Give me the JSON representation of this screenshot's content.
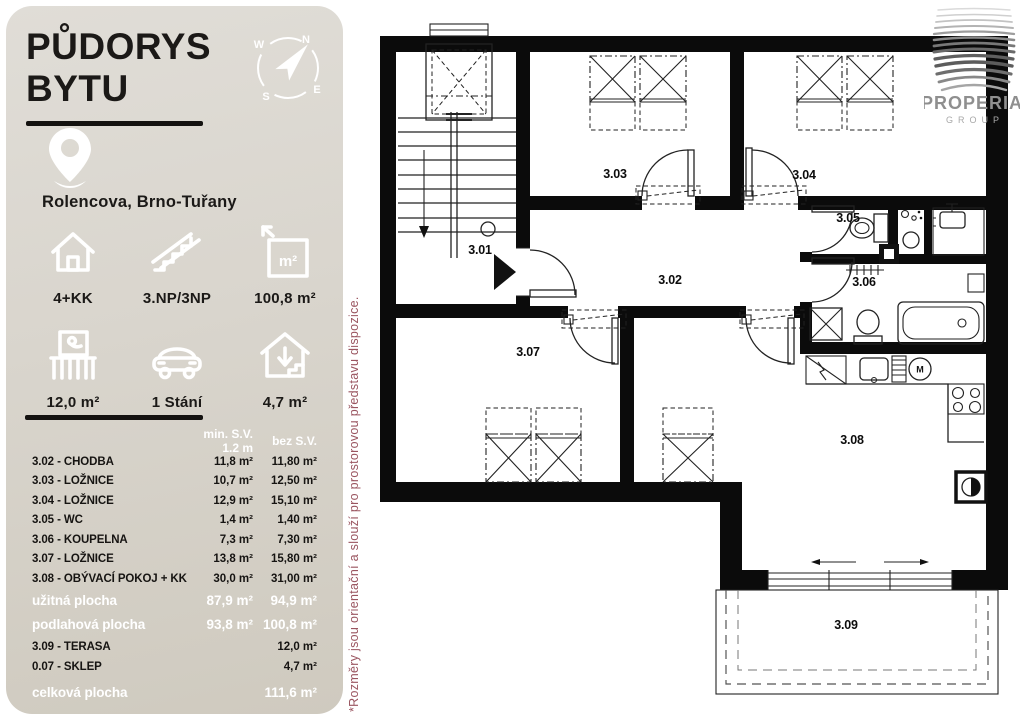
{
  "sidebar": {
    "title_line1": "PŮDORYS",
    "title_line2": "BYTU",
    "location": "Rolencova, Brno-Tuřany",
    "stats": [
      {
        "icon": "house-icon",
        "label": "4+KK"
      },
      {
        "icon": "stairs-icon",
        "label": "3.NP/3NP"
      },
      {
        "icon": "area-icon",
        "label": "100,8 m²"
      },
      {
        "icon": "balcony-icon",
        "label": "12,0 m²"
      },
      {
        "icon": "car-icon",
        "label": "1 Stání"
      },
      {
        "icon": "cellar-icon",
        "label": "4,7 m²"
      }
    ],
    "table": {
      "col1_header": "min. S.V. 1.2 m",
      "col2_header": "bez S.V.",
      "rows": [
        {
          "name": "3.02 - CHODBA",
          "v1": "11,8 m²",
          "v2": "11,80 m²"
        },
        {
          "name": "3.03 - LOŽNICE",
          "v1": "10,7 m²",
          "v2": "12,50 m²"
        },
        {
          "name": "3.04 - LOŽNICE",
          "v1": "12,9 m²",
          "v2": "15,10 m²"
        },
        {
          "name": "3.05 - WC",
          "v1": "1,4 m²",
          "v2": "1,40 m²"
        },
        {
          "name": "3.06 - KOUPELNA",
          "v1": "7,3 m²",
          "v2": "7,30 m²"
        },
        {
          "name": "3.07 - LOŽNICE",
          "v1": "13,8 m²",
          "v2": "15,80 m²"
        },
        {
          "name": "3.08 - OBÝVACÍ POKOJ + KK",
          "v1": "30,0 m²",
          "v2": "31,00 m²"
        }
      ],
      "summary_rows": [
        {
          "name": "užitná plocha",
          "v1": "87,9 m²",
          "v2": "94,9 m²"
        },
        {
          "name": "podlahová plocha",
          "v1": "93,8 m²",
          "v2": "100,8 m²"
        }
      ],
      "extra_rows": [
        {
          "name": "3.09 - TERASA",
          "v1": "",
          "v2": "12,0 m²"
        },
        {
          "name": "0.07 - SKLEP",
          "v1": "",
          "v2": "4,7 m²"
        }
      ],
      "total_row": {
        "name": "celková plocha",
        "v2": "111,6 m²"
      }
    }
  },
  "compass": {
    "n": "N",
    "e": "E",
    "s": "S",
    "w": "W"
  },
  "glyphs": {
    "m2": "m²",
    "washer": "M"
  },
  "note": "*Rozměry jsou orientační a slouží pro prostorovou představu dispozice.",
  "logo": {
    "brand": "PROPERIA",
    "group": "GROUP"
  },
  "plan": {
    "washer_label": "M",
    "rooms": [
      {
        "label": "3.01"
      },
      {
        "label": "3.02"
      },
      {
        "label": "3.03"
      },
      {
        "label": "3.04"
      },
      {
        "label": "3.05"
      },
      {
        "label": "3.06"
      },
      {
        "label": "3.07"
      },
      {
        "label": "3.08"
      },
      {
        "label": "3.09"
      }
    ]
  }
}
